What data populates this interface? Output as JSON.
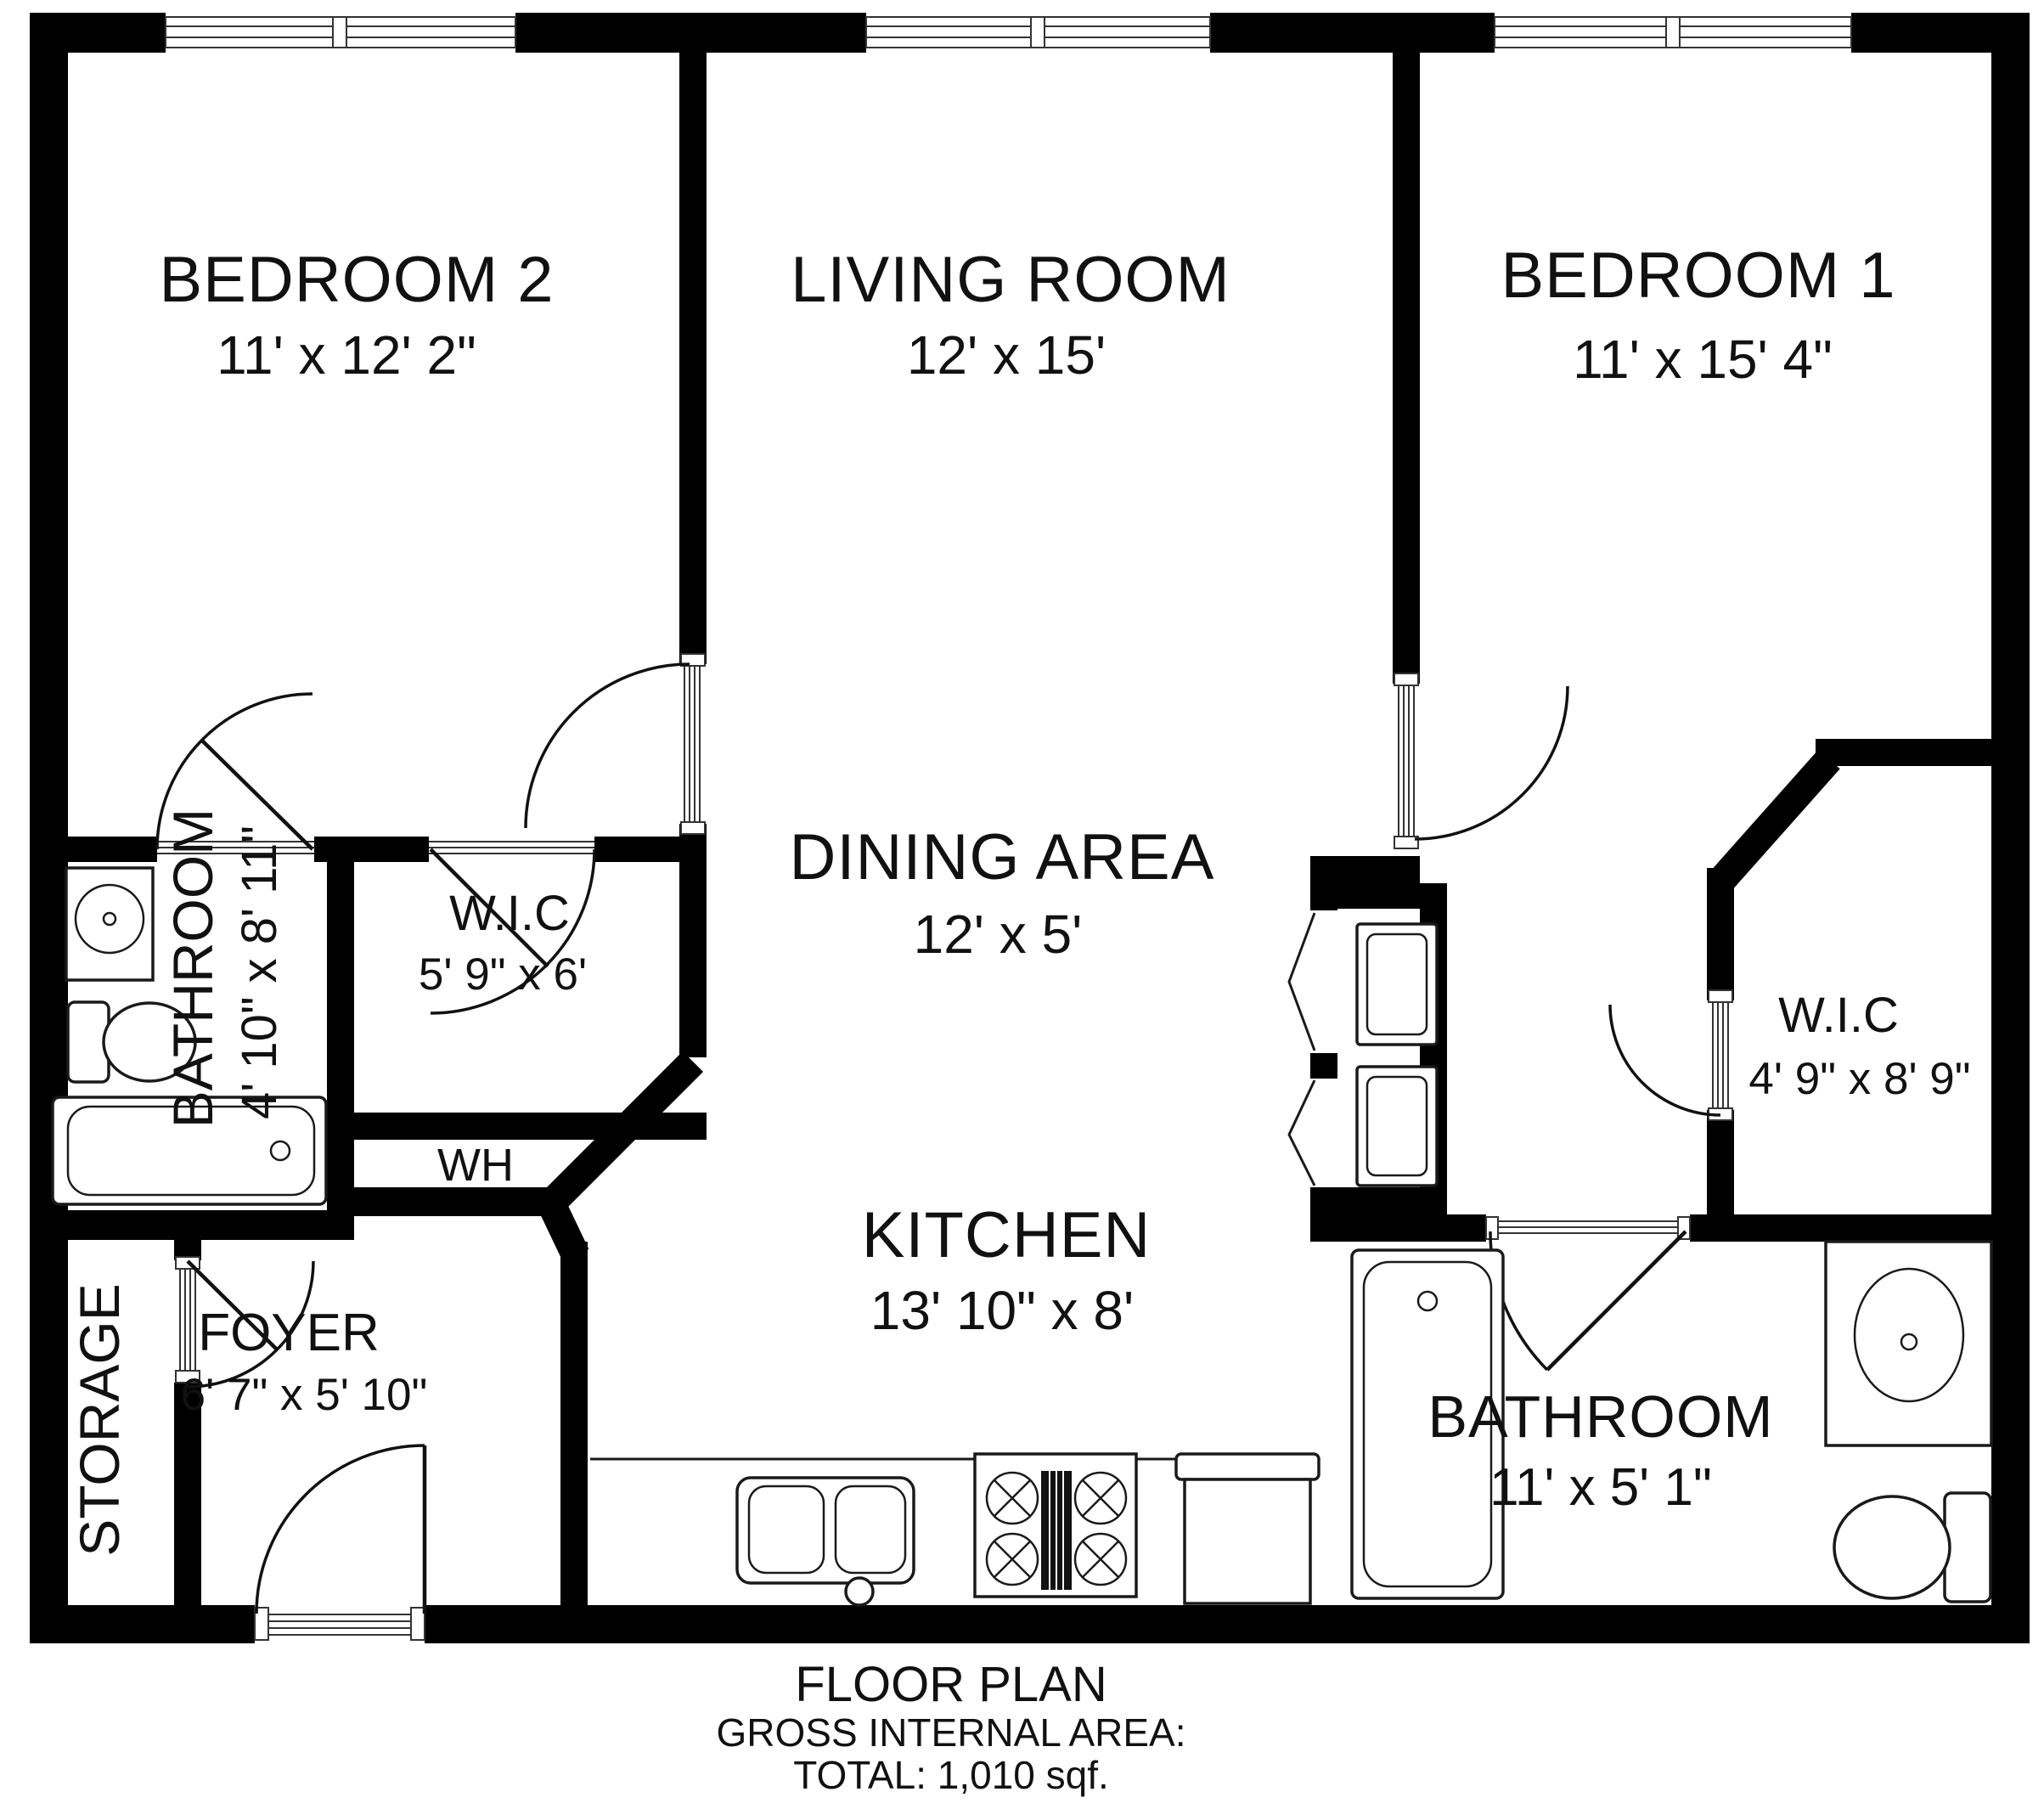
{
  "title": "FLOOR PLAN",
  "rooms": {
    "bedroom2": {
      "label": "BEDROOM 2",
      "dims": "11' x 12' 2\""
    },
    "living": {
      "label": "LIVING ROOM",
      "dims": "12' x 15'"
    },
    "bedroom1": {
      "label": "BEDROOM 1",
      "dims": "11' x 15' 4\""
    },
    "bathroom1": {
      "label": "BATHROOM",
      "dims": "4' 10\" x 8' 11\""
    },
    "wic1": {
      "label": "W.I.C",
      "dims": "5' 9\" x 6'"
    },
    "dining": {
      "label": "DINING AREA",
      "dims": "12' x 5'"
    },
    "wic2": {
      "label": "W.I.C",
      "dims": "4' 9\" x 8' 9\""
    },
    "wh": {
      "label": "WH"
    },
    "kitchen": {
      "label": "KITCHEN",
      "dims": "13' 10\" x 8'"
    },
    "storage": {
      "label": "STORAGE"
    },
    "foyer": {
      "label": "FOYER",
      "dims": "6' 7\" x 5' 10\""
    },
    "bathroom2": {
      "label": "BATHROOM",
      "dims": "11' x 5' 1\""
    }
  },
  "footer": {
    "title": "FLOOR PLAN",
    "area_heading": "GROSS INTERNAL AREA:",
    "total": "TOTAL: 1,010 sqf."
  },
  "colors": {
    "wall": "#000000",
    "background": "#ffffff",
    "text": "#111111"
  }
}
